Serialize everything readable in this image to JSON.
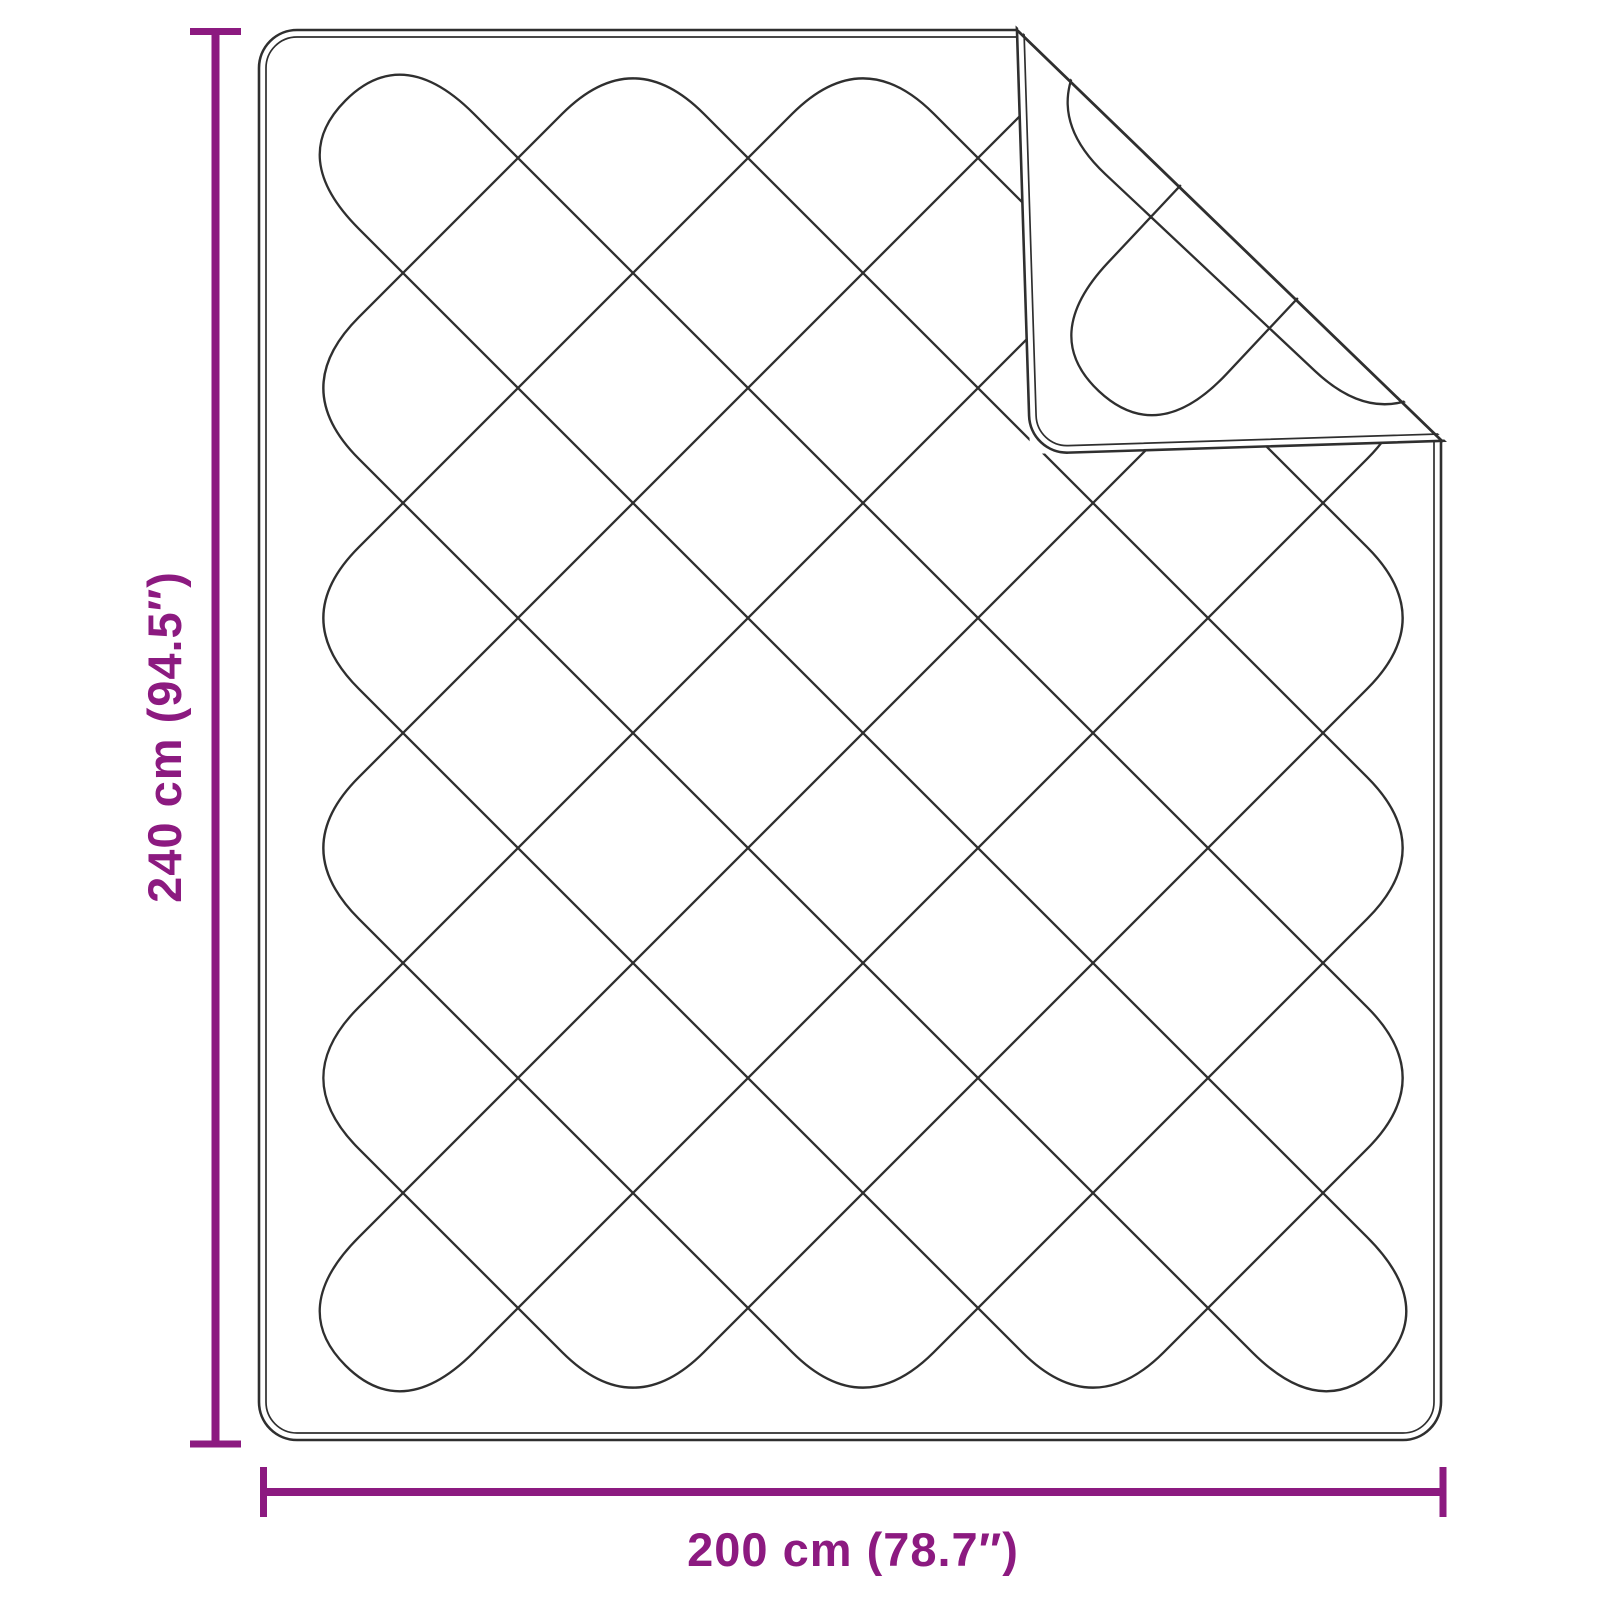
{
  "diagram": {
    "labels": {
      "height": "240 cm (94.5″)",
      "width": "200 cm (78.7″)"
    },
    "colors": {
      "ink": "#2f2f2f",
      "dimension": "#8c1a80",
      "fabric": "#ffffff"
    }
  }
}
